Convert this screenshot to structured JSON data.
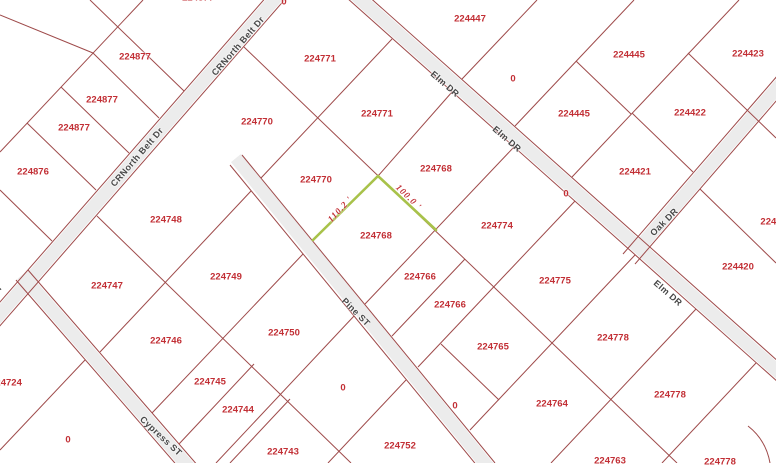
{
  "map": {
    "selected_parcel": {
      "id": "224768",
      "edge_lengths": [
        "110.2 '",
        "100.0 '"
      ],
      "highlight_color": "#a8c24a"
    },
    "colors": {
      "background": "#ffffff",
      "parcel_line": "#9e4a4a",
      "parcel_label": "#c22f35",
      "street_label": "#474747",
      "road_fill": "#ececec",
      "highlight": "#a8c24a"
    },
    "street_names": [
      "CRNorth Belt Dr",
      "Elm DR",
      "Oak DR",
      "Pine ST",
      "Cypress ST"
    ],
    "labels": [
      {
        "text": "224877",
        "x": 135,
        "y": 57,
        "rot": 0,
        "type": "parcel"
      },
      {
        "text": "224877",
        "x": 102,
        "y": 100,
        "rot": 0,
        "type": "parcel"
      },
      {
        "text": "224877",
        "x": 74,
        "y": 128,
        "rot": 0,
        "type": "parcel"
      },
      {
        "text": "224877",
        "x": 198,
        "y": -2,
        "rot": 0,
        "type": "parcel"
      },
      {
        "text": "224876",
        "x": 33,
        "y": 172,
        "rot": 0,
        "type": "parcel"
      },
      {
        "text": "224771",
        "x": 320,
        "y": 59,
        "rot": 0,
        "type": "parcel"
      },
      {
        "text": "224771",
        "x": 377,
        "y": 114,
        "rot": 0,
        "type": "parcel"
      },
      {
        "text": "224770",
        "x": 257,
        "y": 122,
        "rot": 0,
        "type": "parcel"
      },
      {
        "text": "224770",
        "x": 316,
        "y": 180,
        "rot": 0,
        "type": "parcel"
      },
      {
        "text": "224447",
        "x": 470,
        "y": 19,
        "rot": 0,
        "type": "parcel"
      },
      {
        "text": "224445",
        "x": 629,
        "y": 55,
        "rot": 0,
        "type": "parcel"
      },
      {
        "text": "224445",
        "x": 574,
        "y": 114,
        "rot": 0,
        "type": "parcel"
      },
      {
        "text": "224423",
        "x": 748,
        "y": 54,
        "rot": 0,
        "type": "parcel"
      },
      {
        "text": "224422",
        "x": 690,
        "y": 113,
        "rot": 0,
        "type": "parcel"
      },
      {
        "text": "224421",
        "x": 635,
        "y": 172,
        "rot": 0,
        "type": "parcel"
      },
      {
        "text": "224768",
        "x": 436,
        "y": 169,
        "rot": 0,
        "type": "parcel"
      },
      {
        "text": "224768",
        "x": 376,
        "y": 236,
        "rot": 0,
        "type": "parcel"
      },
      {
        "text": "224774",
        "x": 497,
        "y": 226,
        "rot": 0,
        "type": "parcel"
      },
      {
        "text": "224748",
        "x": 166,
        "y": 220,
        "rot": 0,
        "type": "parcel"
      },
      {
        "text": "224749",
        "x": 226,
        "y": 277,
        "rot": 0,
        "type": "parcel"
      },
      {
        "text": "224747",
        "x": 107,
        "y": 286,
        "rot": 0,
        "type": "parcel"
      },
      {
        "text": "224766",
        "x": 420,
        "y": 277,
        "rot": 0,
        "type": "parcel"
      },
      {
        "text": "224766",
        "x": 450,
        "y": 305,
        "rot": 0,
        "type": "parcel"
      },
      {
        "text": "224775",
        "x": 555,
        "y": 281,
        "rot": 0,
        "type": "parcel"
      },
      {
        "text": "224420",
        "x": 738,
        "y": 267,
        "rot": 0,
        "type": "parcel"
      },
      {
        "text": "2244",
        "x": 771,
        "y": 222,
        "rot": 0,
        "type": "parcel"
      },
      {
        "text": "224724",
        "x": 6,
        "y": 383,
        "rot": 0,
        "type": "parcel"
      },
      {
        "text": "224746",
        "x": 166,
        "y": 341,
        "rot": 0,
        "type": "parcel"
      },
      {
        "text": "224745",
        "x": 210,
        "y": 382,
        "rot": 0,
        "type": "parcel"
      },
      {
        "text": "224744",
        "x": 238,
        "y": 410,
        "rot": 0,
        "type": "parcel"
      },
      {
        "text": "224743",
        "x": 283,
        "y": 452,
        "rot": 0,
        "type": "parcel"
      },
      {
        "text": "224750",
        "x": 284,
        "y": 333,
        "rot": 0,
        "type": "parcel"
      },
      {
        "text": "224752",
        "x": 400,
        "y": 446,
        "rot": 0,
        "type": "parcel"
      },
      {
        "text": "224765",
        "x": 493,
        "y": 347,
        "rot": 0,
        "type": "parcel"
      },
      {
        "text": "224764",
        "x": 552,
        "y": 404,
        "rot": 0,
        "type": "parcel"
      },
      {
        "text": "224778",
        "x": 613,
        "y": 338,
        "rot": 0,
        "type": "parcel"
      },
      {
        "text": "224778",
        "x": 670,
        "y": 395,
        "rot": 0,
        "type": "parcel"
      },
      {
        "text": "224778",
        "x": 720,
        "y": 462,
        "rot": 0,
        "type": "parcel"
      },
      {
        "text": "224763",
        "x": 610,
        "y": 461,
        "rot": 0,
        "type": "parcel"
      },
      {
        "text": "0",
        "x": 284,
        "y": 2,
        "rot": 0,
        "type": "parcel"
      },
      {
        "text": "0",
        "x": 513,
        "y": 79,
        "rot": 0,
        "type": "parcel"
      },
      {
        "text": "0",
        "x": 566,
        "y": 194,
        "rot": 0,
        "type": "parcel"
      },
      {
        "text": "0",
        "x": 343,
        "y": 388,
        "rot": 0,
        "type": "parcel"
      },
      {
        "text": "0",
        "x": 455,
        "y": 406,
        "rot": 0,
        "type": "parcel"
      },
      {
        "text": "0",
        "x": 68,
        "y": 440,
        "rot": 0,
        "type": "parcel"
      },
      {
        "text": "CRNorth Belt Dr",
        "x": 238,
        "y": 46,
        "rot": -49,
        "type": "street"
      },
      {
        "text": "CRNorth Belt Dr",
        "x": 137,
        "y": 157,
        "rot": -49,
        "type": "street"
      },
      {
        "text": "CRNorth Belt Dr",
        "x": -24,
        "y": 314,
        "rot": -49,
        "type": "street"
      },
      {
        "text": "Elm DR",
        "x": 445,
        "y": 84,
        "rot": 41,
        "type": "street"
      },
      {
        "text": "Elm DR",
        "x": 507,
        "y": 139,
        "rot": 41,
        "type": "street"
      },
      {
        "text": "Elm DR",
        "x": 668,
        "y": 293,
        "rot": 41,
        "type": "street"
      },
      {
        "text": "Oak DR",
        "x": 664,
        "y": 222,
        "rot": -45,
        "type": "street"
      },
      {
        "text": "Pine ST",
        "x": 356,
        "y": 312,
        "rot": 45,
        "type": "street"
      },
      {
        "text": "Cypress ST",
        "x": 161,
        "y": 436,
        "rot": 43,
        "type": "street"
      },
      {
        "text": "110.2 '",
        "x": 340,
        "y": 209,
        "rot": -47,
        "type": "measure"
      },
      {
        "text": "100.0 '",
        "x": 409,
        "y": 197,
        "rot": 44,
        "type": "measure"
      }
    ]
  }
}
